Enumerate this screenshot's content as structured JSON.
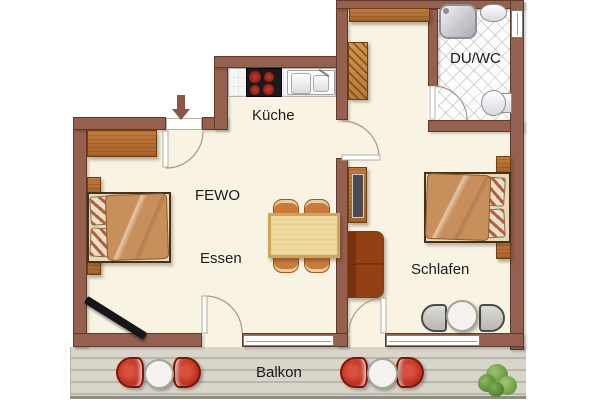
{
  "plan": {
    "labels": {
      "kitchen": "Küche",
      "bathroom": "DU/WC",
      "living": "FEWO",
      "dining": "Essen",
      "bedroom": "Schlafen",
      "balcony": "Balkon"
    },
    "colors": {
      "wall": "#96604e",
      "floor": "#f8f3e2",
      "bath_tile": "#fdfdfd",
      "deck": "#d7d4ca",
      "wood": "#b5713a",
      "dining_table": "#eeda9f",
      "chair_red": "#bf2d1c",
      "burner_red": "#a01d12",
      "text": "#1c1c1c"
    },
    "icons": {
      "entrance_arrow": "▼"
    }
  }
}
